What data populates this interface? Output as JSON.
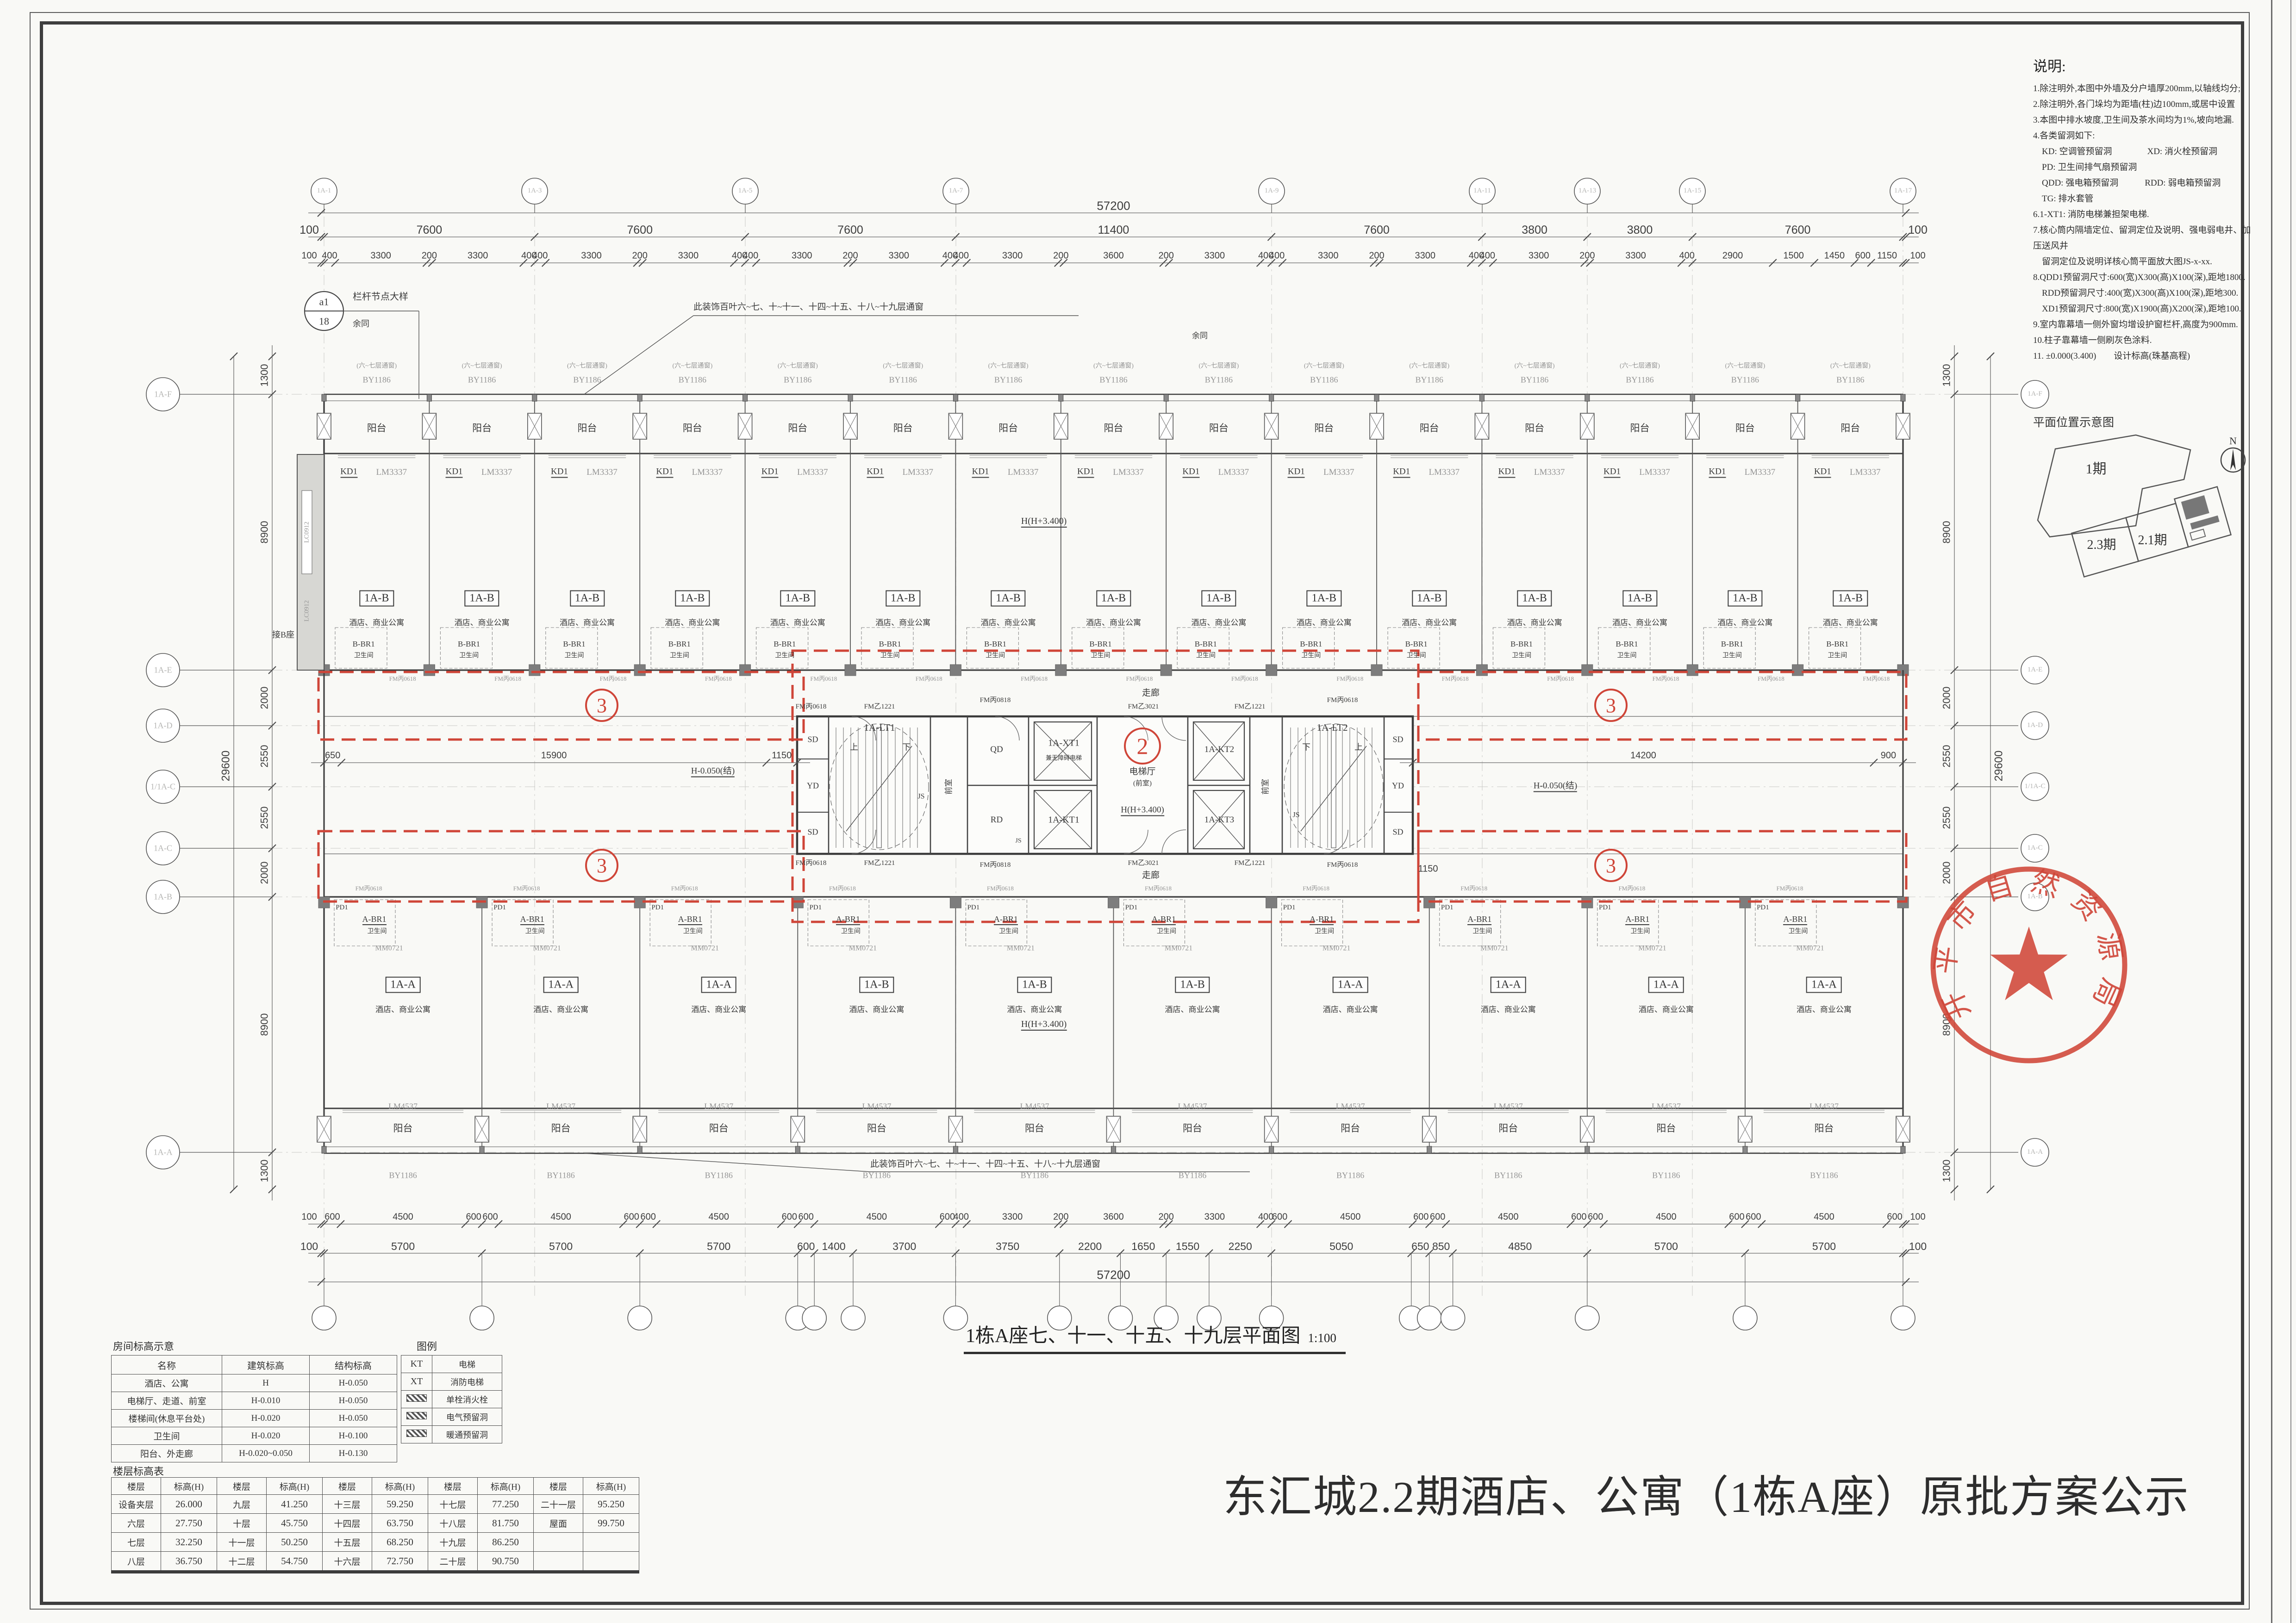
{
  "titles": {
    "drawing_title": "1栋A座七、十一、十五、十九层平面图",
    "drawing_scale": "1:100",
    "public_notice": "东汇城2.2期酒店、公寓（1栋A座）原批方案公示"
  },
  "notes": {
    "title": "说明:",
    "lines": [
      "1.除注明外,本图中外墙及分户墙厚200mm,以轴线均分;",
      "2.除注明外,各门垛均为距墙(柱)边100mm,或居中设置",
      "3.本图中排水坡度,卫生间及茶水间均为1%,坡向地漏.",
      "4.各类留洞如下:",
      "　KD: 空调管预留洞　　　　XD: 消火栓预留洞",
      "　PD: 卫生间排气扇预留洞",
      "　QDD: 强电箱预留洞　　　RDD: 弱电箱预留洞",
      "　TG: 排水套管",
      "6.1-XT1: 消防电梯兼担架电梯.",
      "7.核心筒内隔墙定位、留洞定位及说明、强电弱电井、加压送风井",
      "　留洞定位及说明详核心筒平面放大图JS-x-xx.",
      "8.QDD1预留洞尺寸:600(宽)X300(高)X100(深),距地1800.",
      "　RDD预留洞尺寸:400(宽)X300(高)X100(深),距地300.",
      "　XD1预留洞尺寸:800(宽)X1900(高)X200(深),距地100.",
      "9.室内靠幕墙一侧外窗均增设护窗栏杆,高度为900mm.",
      "10.柱子靠幕墙一侧刷灰色涂料.",
      "11. ±0.000(3.400)　　设计标高(珠基高程)"
    ]
  },
  "key_plan": {
    "title": "平面位置示意图",
    "area1": "1期",
    "area2": "2.3期",
    "area3": "2.1期",
    "north": "N"
  },
  "stamp": {
    "text": "开平市自然资源局",
    "color": "#cf4538"
  },
  "room_table": {
    "title": "房间标高示意",
    "legend_title": "图例",
    "headers": [
      "名称",
      "建筑标高",
      "结构标高"
    ],
    "rows": [
      [
        "酒店、公寓",
        "H",
        "H-0.050"
      ],
      [
        "电梯厅、走道、前室",
        "H-0.010",
        "H-0.050"
      ],
      [
        "楼梯间(休息平台处)",
        "H-0.020",
        "H-0.050"
      ],
      [
        "卫生间",
        "H-0.020",
        "H-0.100"
      ],
      [
        "阳台、外走廊",
        "H-0.020~0.050",
        "H-0.130"
      ]
    ],
    "legend": [
      [
        "KT",
        "电梯"
      ],
      [
        "XT",
        "消防电梯"
      ],
      [
        "",
        "单栓消火栓"
      ],
      [
        "",
        "电气预留洞"
      ],
      [
        "",
        "暖通预留洞"
      ]
    ]
  },
  "floor_table": {
    "title": "楼层标高表",
    "col_floor": "楼层",
    "col_level": "标高(H)",
    "rows": [
      [
        "设备夹层",
        "26.000",
        "九层",
        "41.250",
        "十三层",
        "59.250",
        "十七层",
        "77.250",
        "二十一层",
        "95.250"
      ],
      [
        "六层",
        "27.750",
        "十层",
        "45.750",
        "十四层",
        "63.750",
        "十八层",
        "81.750",
        "屋面",
        "99.750"
      ],
      [
        "七层",
        "32.250",
        "十一层",
        "50.250",
        "十五层",
        "68.250",
        "十九层",
        "86.250",
        "",
        ""
      ],
      [
        "八层",
        "36.750",
        "十二层",
        "54.750",
        "十六层",
        "72.750",
        "二十层",
        "90.750",
        "",
        ""
      ]
    ]
  },
  "plan": {
    "top_unit_labels": [
      "1A-B",
      "1A-B",
      "1A-B",
      "1A-B",
      "1A-B",
      "1A-B",
      "1A-B",
      "1A-B",
      "1A-B",
      "1A-B",
      "1A-B",
      "1A-B",
      "1A-B",
      "1A-B",
      "1A-B"
    ],
    "bottom_unit_labels": [
      "1A-A",
      "1A-A",
      "1A-A",
      "1A-B",
      "1A-B",
      "1A-B",
      "1A-A",
      "1A-A",
      "1A-A",
      "1A-A"
    ],
    "unit_sub": "酒店、商业公寓",
    "balcony": "阳台",
    "window_top": "BY1186",
    "window_note": "(六~七层通窗)",
    "same_note": "余同",
    "kd": "KD1",
    "door_top": "LM3337",
    "bath_top": "B-BR1",
    "bath_bottom": "A-BR1",
    "bath_room": "卫生间",
    "pd": "PD1",
    "window_mid": "MM0721",
    "window_bottom": "LM4537",
    "door_unit": "FM丙0618",
    "corridor": "走廊",
    "louver_note": "此装饰百叶六~七、十~十一、十四~十五、十八~十九层通窗",
    "connect_b": "接B座",
    "lc": "LC0912",
    "callout_a": "a1",
    "callout_b": "18",
    "callout_label": "栏杆节点大样",
    "callout_sub": "余同",
    "c2": "2",
    "c3": "3",
    "lvl_hall": "H(H+3.400)",
    "lvl_corr": "H-0.050(结)",
    "core": {
      "stair_l": "1A-LT1",
      "stair_r": "1A-LT2",
      "up": "上",
      "down": "下",
      "sd": "SD",
      "yd": "YD",
      "js": "JS",
      "qd": "QD",
      "rd": "RD",
      "front": "前室",
      "xt": "1A-XT1",
      "xt_sub": "兼无障碍电梯",
      "kt1": "1A-KT1",
      "kt2": "1A-KT2",
      "kt3": "1A-KT3",
      "hall": "电梯厅",
      "hall_sub": "(前室)",
      "fm1221": "FM乙1221",
      "fm0818": "FM丙0818",
      "fm3021": "FM乙3021",
      "fm0618": "FM丙0618"
    }
  },
  "dims": {
    "top_total": "57200",
    "top_bays": [
      "100",
      "7600",
      "7600",
      "7600",
      "11400",
      "7600",
      "3800",
      "3800",
      "7600",
      "100"
    ],
    "top_fine": [
      "100",
      "400",
      "3300",
      "200",
      "3300",
      "400",
      "400",
      "3300",
      "200",
      "3300",
      "400",
      "400",
      "3300",
      "200",
      "3300",
      "400",
      "400",
      "3300",
      "200",
      "3600",
      "200",
      "3300",
      "400",
      "400",
      "3300",
      "200",
      "3300",
      "400",
      "400",
      "3300",
      "200",
      "3300",
      "400",
      "2900",
      "1500",
      "1450",
      "600",
      "1150",
      "100"
    ],
    "bottom_fine": [
      "100",
      "600",
      "4500",
      "600",
      "600",
      "4500",
      "600",
      "600",
      "4500",
      "600",
      "600",
      "4500",
      "600",
      "400",
      "3300",
      "200",
      "3600",
      "200",
      "3300",
      "400",
      "600",
      "4500",
      "600",
      "600",
      "4500",
      "600",
      "600",
      "4500",
      "600",
      "600",
      "4500",
      "600",
      "100"
    ],
    "bottom_mid": [
      "100",
      "5700",
      "5700",
      "5700",
      "600",
      "1400",
      "3700",
      "3750",
      "2200",
      "1650",
      "1550",
      "2250",
      "5050",
      "650",
      "850",
      "4850",
      "5700",
      "5700",
      "100"
    ],
    "bottom_total": "57200",
    "left": [
      "1300",
      "8900",
      "2000",
      "2550",
      "2550",
      "2000",
      "8900",
      "1300"
    ],
    "left_total": "29600",
    "right": [
      "1300",
      "8900",
      "2000",
      "2550",
      "2550",
      "2000",
      "8900",
      "1300"
    ],
    "right_total": "29600",
    "mid_left": [
      "650",
      "15900",
      "1150"
    ],
    "mid_right": [
      "14200",
      "900"
    ],
    "mid_right_extra": "1150",
    "grid_top": [
      "1A-1",
      "1A-3",
      "1A-5",
      "1A-7",
      "1A-9",
      "1A-11",
      "1A-13",
      "1A-15",
      "1A-17"
    ],
    "grid_left": [
      "1A-F",
      "1A-E",
      "1A-D",
      "1/1A-C",
      "1A-C",
      "1A-B",
      "1A-A"
    ],
    "grid_right": [
      "1A-F",
      "1A-E",
      "1A-D",
      "1/1A-C",
      "1A-C",
      "1A-B",
      "1A-A"
    ]
  }
}
